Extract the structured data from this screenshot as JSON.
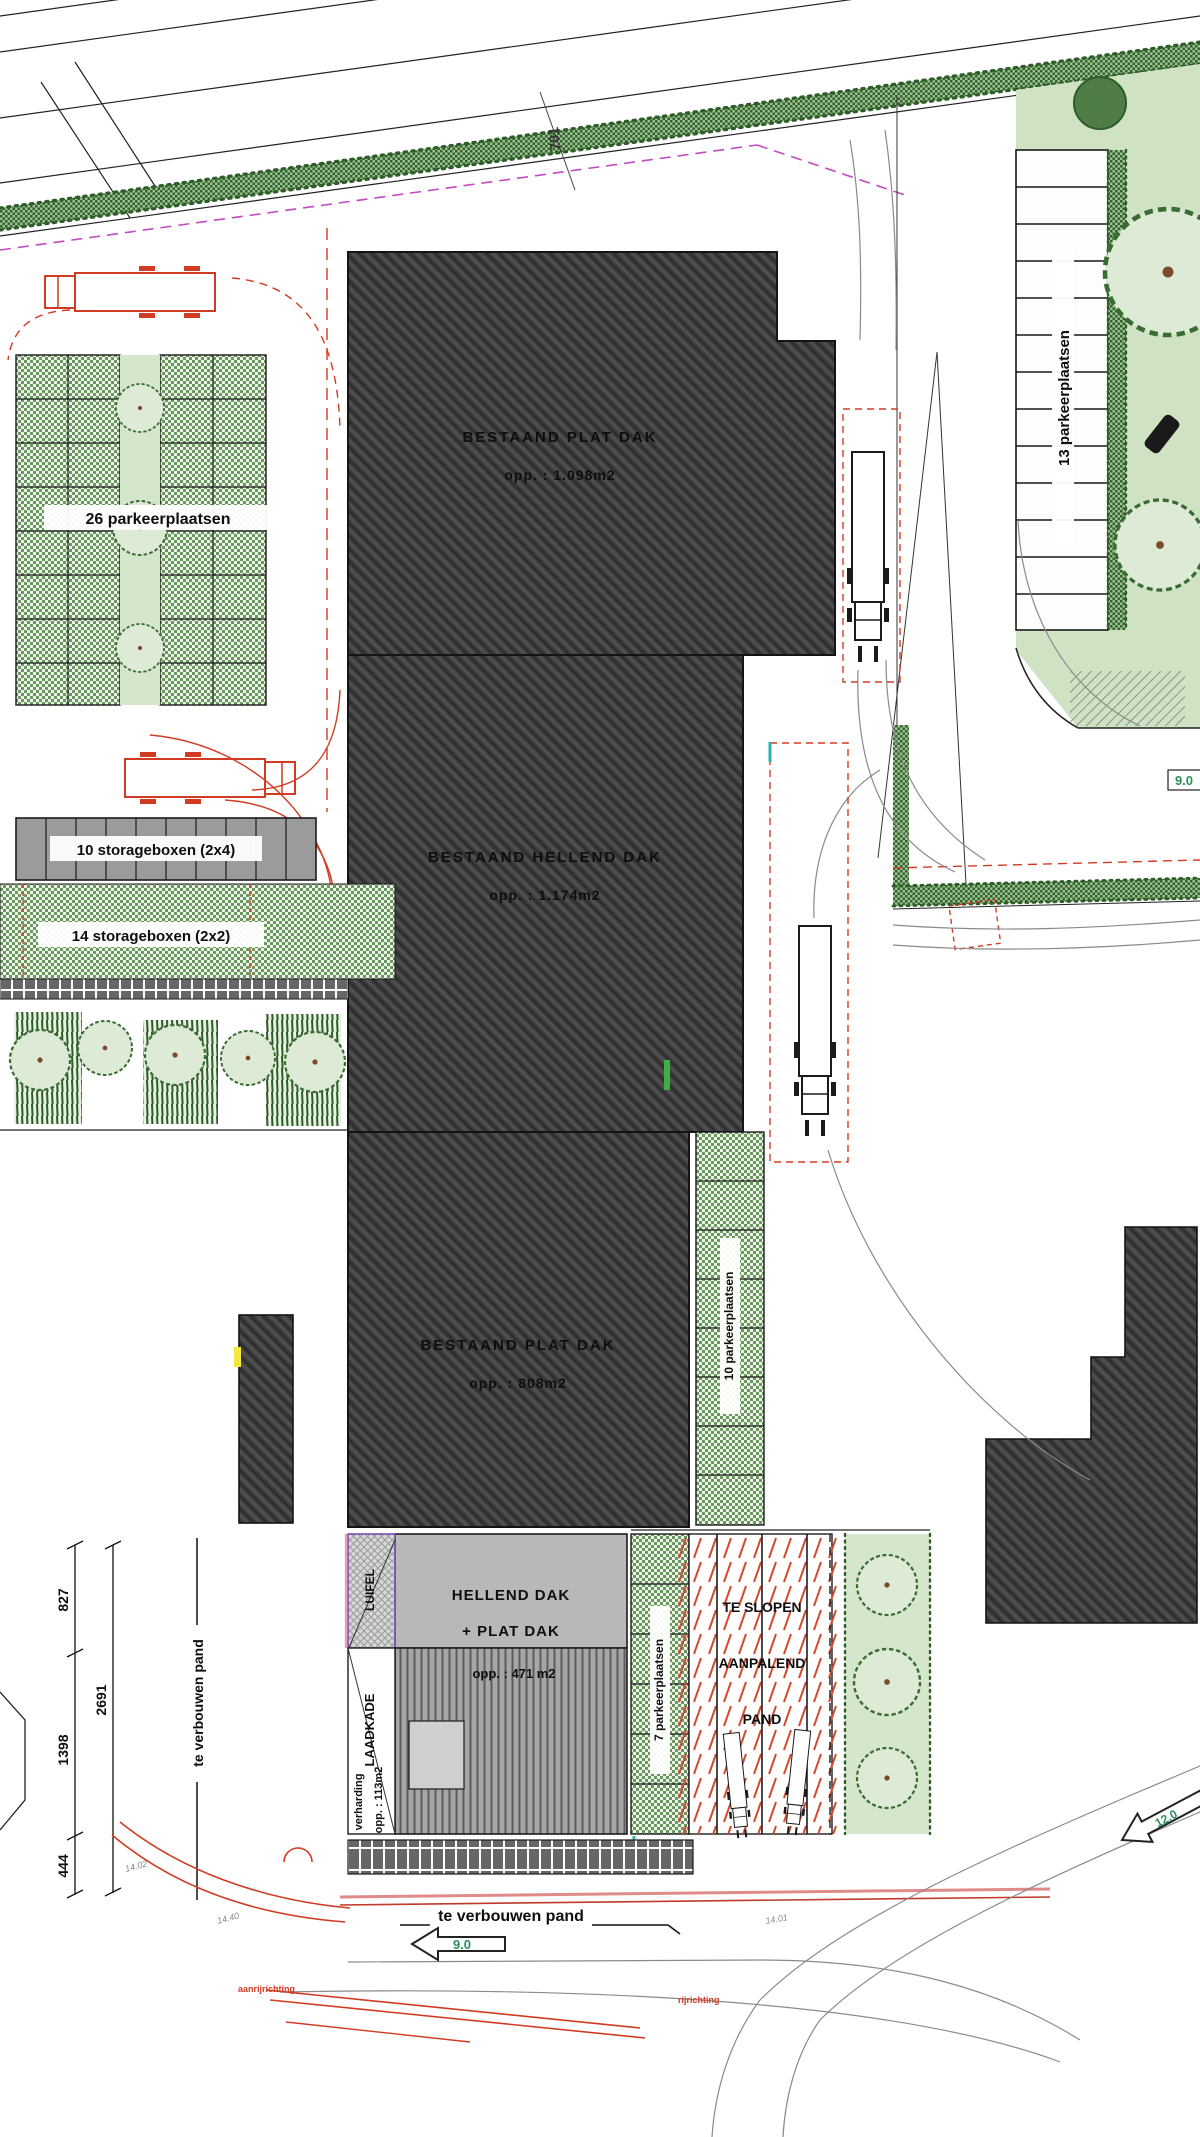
{
  "plan": {
    "buildings": {
      "b1": {
        "name": "BESTAAND PLAT DAK",
        "area": "opp. : 1.098m2"
      },
      "b2": {
        "name": "BESTAAND HELLEND DAK",
        "area": "opp. : 1.174m2"
      },
      "b3": {
        "name": "BESTAAND PLAT DAK",
        "area": "opp. : 808m2"
      },
      "b4": {
        "name1": "HELLEND DAK",
        "name2": "+ PLAT DAK",
        "area": "opp. : 471 m2"
      },
      "demolish": {
        "line1": "TE SLOPEN",
        "line2": "AANPALEND",
        "line3": "PAND"
      }
    },
    "parking": {
      "left": "26 parkeerplaatsen",
      "right": "13 parkeerplaatsen",
      "middle": "10 parkeerplaatsen",
      "south": "7 parkeerplaatsen"
    },
    "storage": {
      "row1": "10 storageboxen (2x4)",
      "row2": "14 storageboxen (2x2)"
    },
    "annotations": {
      "luifel": "LUIFEL",
      "laadkade": "LAADKADE",
      "verharding1": "verharding",
      "verharding2": "opp. : 113m2",
      "te_verbouwen_side": "te verbouwen pand",
      "te_verbouwen_bottom": "te verbouwen pand",
      "street_number": "701",
      "road_width_right": "9.0",
      "road_width_bottom": "9.0",
      "road_width_corner": "12.0",
      "note_left": "aanrijrichting",
      "note_right": "rijrichting",
      "level_a": "14.02",
      "level_b": "14.40",
      "level_c": "14.01"
    },
    "dimensions": {
      "seg1": "827",
      "seg2": "1398",
      "seg3": "2691",
      "seg4": "444"
    },
    "colors": {
      "building_hatch": "#3b3b3b",
      "lawn": "#cfe3c4",
      "hedge_green": "#35602f",
      "checker_green": "#69975f",
      "red_line": "#d23b23",
      "magenta_boundary": "#c24ac2",
      "marker_green": "#2a8f5a"
    }
  }
}
